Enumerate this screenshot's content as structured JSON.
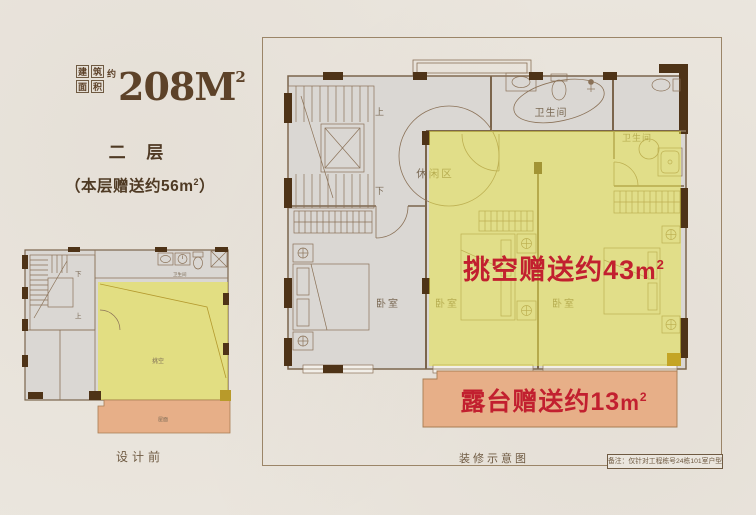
{
  "colors": {
    "page_bg": "#ebe6de",
    "plan_bg": "#dad7d3",
    "wall_dark": "#4e3317",
    "line_brown": "#7b654c",
    "title_brown": "#5d4229",
    "accent_red": "#c2202f",
    "highlight_yellow": "#e8e34d",
    "highlight_orange": "#e7af88"
  },
  "title": {
    "grid_chars": [
      "建",
      "筑",
      "面",
      "积"
    ],
    "approx_char": "约",
    "value": "208M",
    "sup": "2"
  },
  "left_panel": {
    "floor_label": "二 层",
    "bonus_prefix": "（本层赠送约56",
    "bonus_unit": "m",
    "bonus_sup": "2",
    "bonus_suffix": "）",
    "caption": "设计前"
  },
  "mini_plan": {
    "down_label": "下",
    "up_label": "上",
    "bathroom_label": "卫生间",
    "void_label": "挑空",
    "roof_label": "屋面"
  },
  "main_plan": {
    "up_label": "上",
    "down_label": "下",
    "leisure_label": "休闲区",
    "bathroom1_label": "卫生间",
    "bathroom2_label": "卫生间",
    "bedroom1_label": "卧室",
    "bedroom2_label": "卧室",
    "bedroom3_label": "卧室",
    "caption": "装修示意图",
    "note": "备注：仅针对工程栋号24栋101室户型"
  },
  "highlights": {
    "void_text": "挑空赠送约43",
    "void_unit": "m",
    "void_sup": "2",
    "terrace_text": "露台赠送约13",
    "terrace_unit": "m",
    "terrace_sup": "2"
  }
}
